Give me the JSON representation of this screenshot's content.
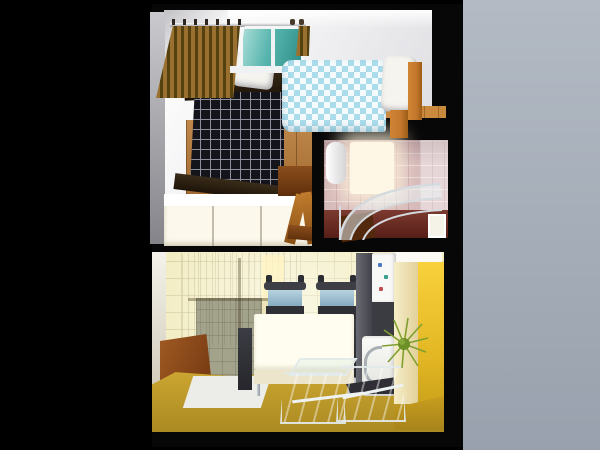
{
  "scene": {
    "title": "3D rendered bird's-eye floor plan of a one-bedroom apartment",
    "view": "top-down perspective architectural render",
    "background": {
      "left": "black",
      "right": "light blue-gray gradient"
    },
    "rooms": [
      {
        "name": "Bedroom",
        "position": "top-left",
        "objects": [
          "curtain rod with rings",
          "wooden slat curtain",
          "window with teal glass",
          "bed with dark checkered cover",
          "two white pillows",
          "single bed with light-blue checkered duvet",
          "white bed pillow",
          "wooden bed frame rails",
          "wooden plank floor",
          "white wardrobe",
          "wooden desk",
          "wooden chair"
        ]
      },
      {
        "name": "Bathroom",
        "position": "middle-right",
        "objects": [
          "pink tiled walls",
          "bright window light",
          "white water heater",
          "curved chrome and glass shower canopy",
          "dark red-brown floor",
          "brown floor object",
          "white door frame"
        ]
      },
      {
        "name": "Kitchen / living room",
        "position": "bottom",
        "objects": [
          "pale yellow tiled floor",
          "gray-green tiled area",
          "wicker sofa",
          "brown wooden cabinet",
          "white floor mat",
          "white dining table",
          "two chairs with blue backrests",
          "chrome table legs",
          "dark side chairs",
          "tilted teal glass panels",
          "refrigerator with magnets",
          "dark appliance column",
          "white washing machine with chrome handle",
          "tall cream cabinet",
          "bright yellow tiled wall",
          "green spiky plant",
          "mustard floor strip",
          "white doorway sliver"
        ]
      }
    ]
  },
  "palette": {
    "black": "#000000",
    "black2": "#070707",
    "backdrop-hi": "#b3bac4",
    "backdrop-lo": "#98a1ad",
    "wall-white": "#ffffff",
    "wall-shade": "#d8d8dd",
    "leftwall-hi": "#cacace",
    "leftwall-lo": "#84848a",
    "wood-hi": "#c98a3e",
    "wood-mid": "#aa6a28",
    "wood-lo": "#8a5018",
    "checker-base": "#14141b",
    "checker-line": "#8e8e9c",
    "pillow": "#f5f4ef",
    "duvet-blue": "#aadcec",
    "duvet-white": "#f5fbfd",
    "bed-wood": "#c2772c",
    "curtain-hi": "#9a7030",
    "curtain-lo": "#55400f",
    "window-teal-hi": "#a8dcd6",
    "window-teal-lo": "#2f8f88",
    "bath-pink": "#d6b9ba",
    "bath-glow": "#fff7e6",
    "bath-floor-hi": "#7c3b30",
    "bath-floor-lo": "#571f18",
    "chrome": "#d5dade",
    "kfloor": "#f3edc4",
    "kgrid": "#dcd5a6",
    "graytile": "#a3a28b",
    "sofa-hi": "#c9bf90",
    "sofa-mid": "#aca274",
    "sofa-lo": "#8e8458",
    "cab-brown-hi": "#a05a22",
    "cab-brown-lo": "#6e3410",
    "mustard-hi": "#cfa933",
    "mustard-lo": "#ab8a22",
    "mat": "#eef0f3",
    "table-top": "#fffdef",
    "table-front": "#ece5cb",
    "chair-frame": "#2f2f36",
    "chair-blue": "#b7d2e0",
    "pane-hi": "#8fd2c6",
    "pane-lo": "#3d948c",
    "pane-frame": "#e2eaea",
    "appl-gray": "#54545c",
    "appl-dark": "#3b3b42",
    "fridge": "#f8f8f6",
    "cream-hi": "#f6eec8",
    "cream-lo": "#e0ce96",
    "ywall-hi": "#f8d13c",
    "ywall-lo": "#c49c18",
    "plant": "#7fa02f",
    "door-white": "#f5f2e8"
  }
}
